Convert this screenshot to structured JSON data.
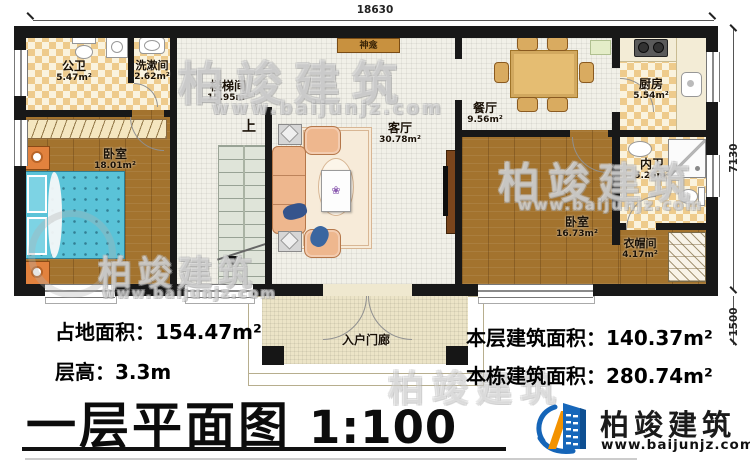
{
  "plan": {
    "dimensions": {
      "top": "18630",
      "right_upper": "7130",
      "right_lower": "1500"
    },
    "rooms": {
      "gongwei": {
        "name": "公卫",
        "area": "5.47m²"
      },
      "xishujian": {
        "name": "洗漱间",
        "area": "2.62m²"
      },
      "loutijian": {
        "name": "楼梯间",
        "area": "15.95m²"
      },
      "bedroom_left": {
        "name": "卧室",
        "area": "18.01m²"
      },
      "keting": {
        "name": "客厅",
        "area": "30.78m²"
      },
      "canting": {
        "name": "餐厅",
        "area": "9.56m²"
      },
      "chufang": {
        "name": "厨房",
        "area": "5.54m²"
      },
      "neiwei": {
        "name": "内卫",
        "area": "5.26m²"
      },
      "bedroom_right": {
        "name": "卧室",
        "area": "16.73m²"
      },
      "yimaojian": {
        "name": "衣帽间",
        "area": "4.17m²"
      },
      "porch": {
        "name": "入户门廊"
      },
      "shenkan": {
        "name": "神龛"
      },
      "stairs": {
        "direction_label": "上"
      }
    }
  },
  "info": {
    "land_area": "占地面积：154.47m²",
    "floor_height": "层高：3.3m",
    "floor_area": "本层建筑面积：140.37m²",
    "building_area": "本栋建筑面积：280.74m²"
  },
  "title": {
    "text": "一层平面图",
    "scale": "1:100"
  },
  "brand": {
    "name": "柏竣建筑",
    "url": "www.baijunjz.com"
  },
  "icons": {
    "flower": "❀"
  },
  "colors": {
    "wall": "#181818",
    "wood": "#a3732e",
    "checker": "#eecb8c",
    "tile": "#f1f0e8",
    "bed_blue": "#5ac3d8",
    "sofa_peach": "#eeb78e",
    "furniture_orange": "#e2823e",
    "brand_blue": "#1565b8",
    "brand_orange": "#f39200"
  }
}
